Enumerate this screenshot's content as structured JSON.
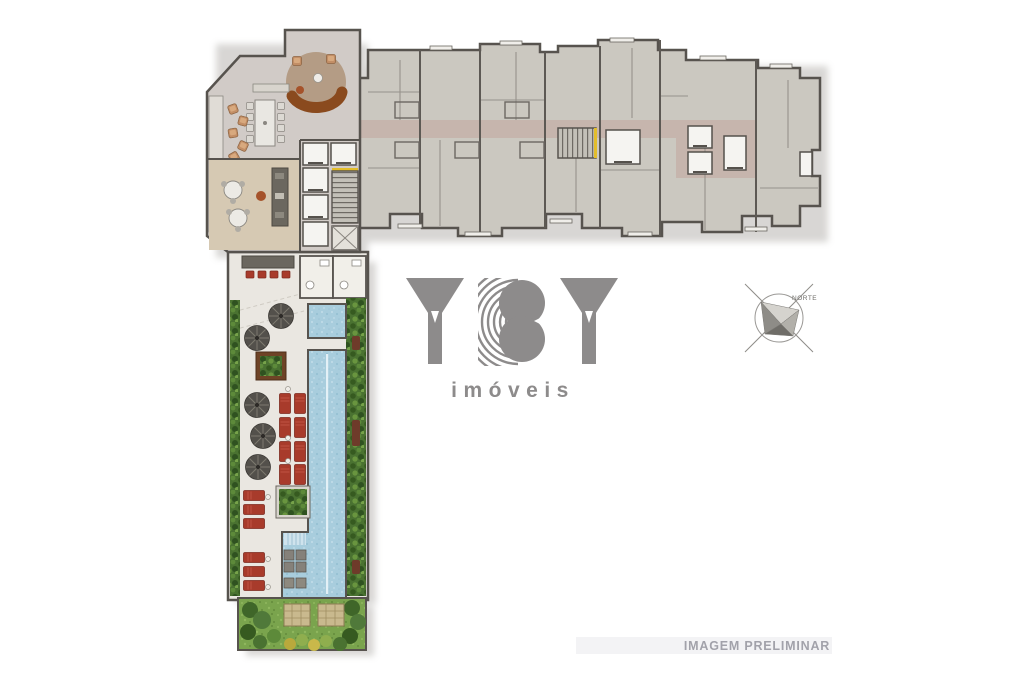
{
  "page": {
    "background": "#ffffff"
  },
  "logo": {
    "brand": "YBY",
    "tagline": "imóveis",
    "color": "#8d8b8b"
  },
  "compass": {
    "label": "NORTE"
  },
  "watermark": {
    "text": "IMAGEM PRELIMINAR"
  },
  "palette": {
    "wall": "#57534e",
    "unit_floor": "#cbc8c0",
    "lobby_floor": "#d1cbc7",
    "lounge_floor": "#d6c9b3",
    "corridor_pink": "#c6b5ad",
    "deck": "#eae7e1",
    "pool_water": "#a8cddd",
    "hedge_green": "#4a7231",
    "lawn_green": "#7aa44d",
    "lounger_red": "#a83b2b",
    "umbrella_gray": "#53504b",
    "stair_accent_yellow": "#e3bd2a",
    "rug_tan": "#b49c85",
    "sofa_brown": "#8a4a1e",
    "watermark_text": "#a2a2aa",
    "watermark_strip": "#f3f3f5"
  }
}
